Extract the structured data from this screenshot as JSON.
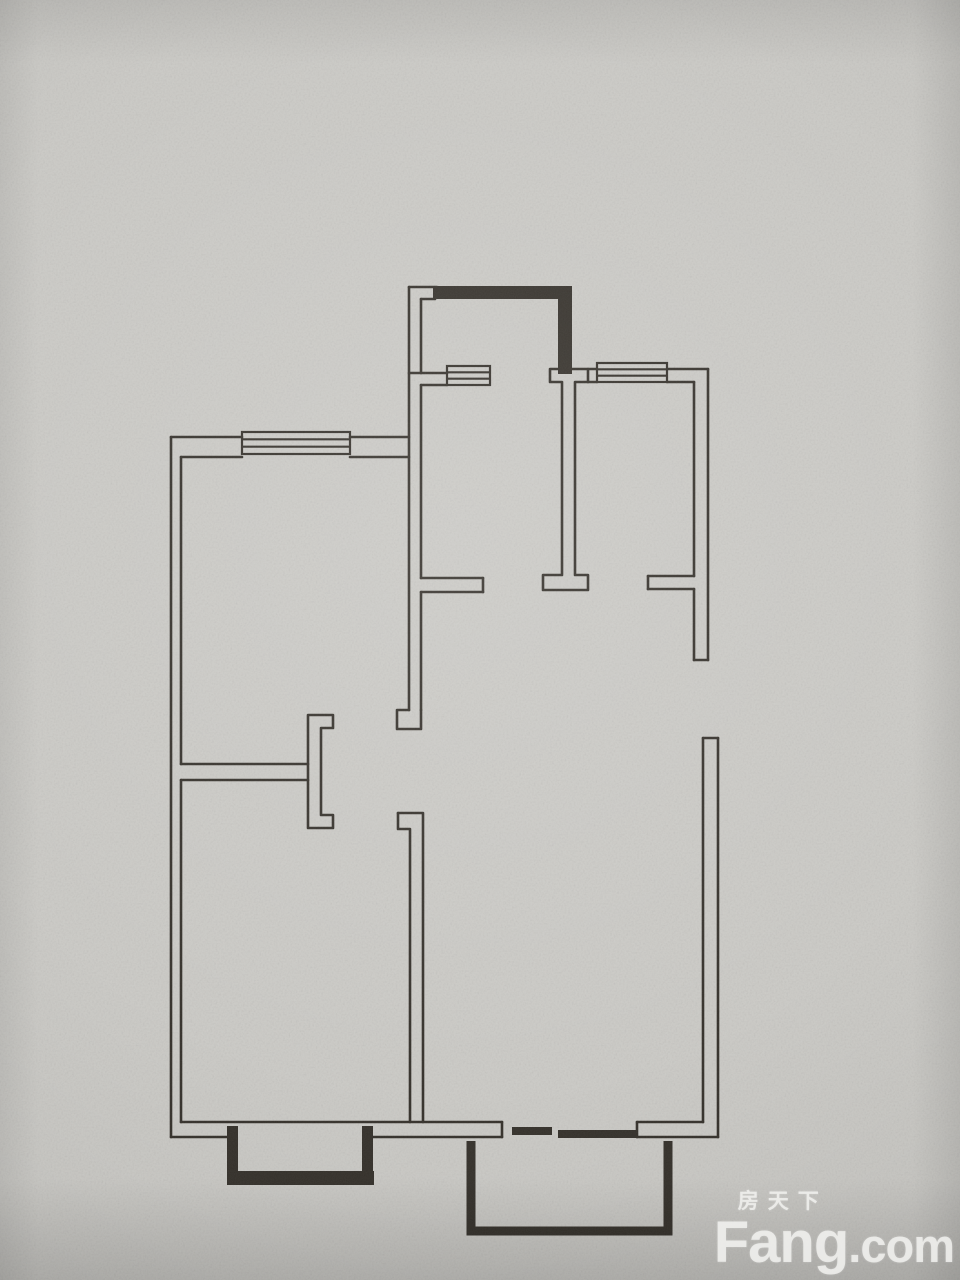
{
  "photo": {
    "paper_color": "#cccbc7",
    "ink_color": "#35312b"
  },
  "watermark": {
    "cn": "房天下",
    "en_main": "Fang",
    "en_suffix": ".com",
    "color": "#f2f2ef"
  },
  "floor_plan": {
    "stroke": "#35312b",
    "stroke_width": 2.6,
    "window_stroke_width": 2.2,
    "segments": [
      [
        171,
        437,
        171,
        1137
      ],
      [
        171,
        437,
        242,
        437
      ],
      [
        350,
        437,
        409,
        437
      ],
      [
        181,
        457,
        242,
        457
      ],
      [
        350,
        457,
        409,
        457
      ],
      [
        181,
        457,
        181,
        764
      ],
      [
        181,
        780,
        181,
        1122
      ],
      [
        181,
        764,
        308,
        764
      ],
      [
        181,
        780,
        308,
        780
      ],
      [
        181,
        1122,
        502,
        1122
      ],
      [
        171,
        1137,
        227,
        1137
      ],
      [
        373,
        1137,
        502,
        1137
      ],
      [
        502,
        1122,
        502,
        1137
      ],
      [
        637,
        1122,
        637,
        1137
      ],
      [
        637,
        1122,
        703,
        1122
      ],
      [
        637,
        1137,
        718,
        1137
      ],
      [
        409,
        287,
        409,
        710
      ],
      [
        421,
        299,
        421,
        373
      ],
      [
        409,
        287,
        437,
        287
      ],
      [
        421,
        299,
        435,
        299
      ],
      [
        409,
        373,
        447,
        373
      ],
      [
        421,
        385,
        447,
        385
      ],
      [
        421,
        385,
        421,
        578
      ],
      [
        421,
        578,
        483,
        578
      ],
      [
        483,
        578,
        483,
        592
      ],
      [
        421,
        592,
        483,
        592
      ],
      [
        421,
        592,
        421,
        710
      ],
      [
        588,
        369,
        597,
        369
      ],
      [
        667,
        369,
        708,
        369
      ],
      [
        588,
        382,
        597,
        382
      ],
      [
        667,
        382,
        694,
        382
      ],
      [
        708,
        369,
        708,
        660
      ],
      [
        694,
        660,
        708,
        660
      ],
      [
        694,
        382,
        694,
        576
      ],
      [
        694,
        589,
        694,
        660
      ],
      [
        648,
        576,
        694,
        576
      ],
      [
        648,
        576,
        648,
        589
      ],
      [
        648,
        589,
        694,
        589
      ],
      [
        703,
        738,
        703,
        1122
      ],
      [
        718,
        738,
        718,
        1137
      ],
      [
        703,
        738,
        718,
        738
      ]
    ],
    "paths": [
      {
        "name": "corridor-wall-foot",
        "d": "M409,710 L397,710 L397,729 L421,729 L421,710"
      },
      {
        "name": "bedroom-door-post",
        "d": "M308,715 L333,715 L333,728 L321,728 L321,815 L333,815 L333,828 L308,828 Z"
      },
      {
        "name": "living-west-wall-right",
        "d": "M398,813 L423,813 L423,1122"
      },
      {
        "name": "living-west-wall-left",
        "d": "M398,813 L398,829 L410,829 L410,1122"
      },
      {
        "name": "hall-i-beam-wall",
        "d": "M550,369 L588,369 L588,382 L575,382 L575,575 L588,575 L588,590 L543,590 L543,575 L562,575 L562,382 L550,382 Z"
      }
    ],
    "thick_paths": [
      {
        "name": "south-balcony",
        "d": "M471,1141 L471,1231 L668,1231 L668,1141",
        "w": 9
      }
    ],
    "fill_rects": [
      {
        "name": "north-balcony-top",
        "x": 433,
        "y": 286,
        "w": 139,
        "h": 13
      },
      {
        "name": "north-balcony-right",
        "x": 558,
        "y": 286,
        "w": 14,
        "h": 88
      },
      {
        "name": "bay-left",
        "x": 227,
        "y": 1126,
        "w": 11,
        "h": 47
      },
      {
        "name": "bay-bottom",
        "x": 227,
        "y": 1171,
        "w": 147,
        "h": 14
      },
      {
        "name": "bay-right",
        "x": 362,
        "y": 1126,
        "w": 11,
        "h": 47
      },
      {
        "name": "balcony-door-bar-a",
        "x": 512,
        "y": 1127,
        "w": 40,
        "h": 8
      },
      {
        "name": "balcony-door-bar-b",
        "x": 558,
        "y": 1130,
        "w": 80,
        "h": 8
      }
    ],
    "windows": [
      {
        "name": "window-west-bedroom",
        "x": 242,
        "y": 432,
        "w": 108,
        "h": 22,
        "lines": 2
      },
      {
        "name": "window-kitchen",
        "x": 447,
        "y": 366,
        "w": 43,
        "h": 19,
        "lines": 2
      },
      {
        "name": "window-northeast-room",
        "x": 597,
        "y": 363,
        "w": 70,
        "h": 19,
        "lines": 2
      }
    ]
  }
}
